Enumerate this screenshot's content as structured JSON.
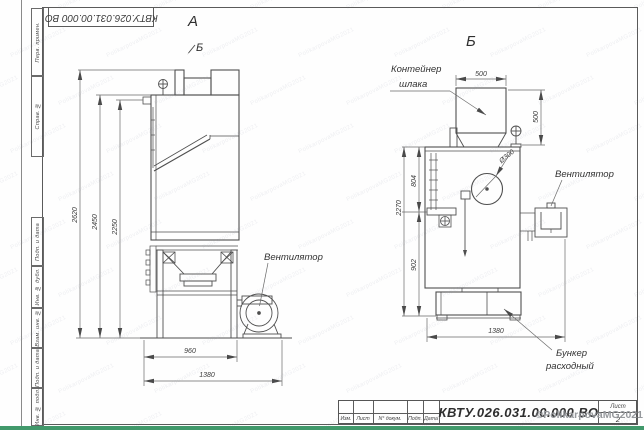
{
  "frame": {
    "top_stamp": "КВТУ.026.031.00.000 ВО",
    "side_fields": [
      {
        "label": "Перв. примен."
      },
      {
        "label": "Справ. №"
      },
      {
        "label": "Подп. и дата"
      },
      {
        "label": "Инв. № дубл."
      },
      {
        "label": "Взам. инв. №"
      },
      {
        "label": "Подп. и дата"
      },
      {
        "label": "Инв. № подл."
      }
    ]
  },
  "title_block": {
    "designation": "КВТУ.026.031.00.000 ВО",
    "columns": [
      "Изм.",
      "Лист",
      "N° докум.",
      "Подп.",
      "Дата"
    ],
    "sheet_label": "Лист",
    "sheet_number": "2"
  },
  "views": {
    "front": {
      "label": "А",
      "direction_label": "Б",
      "dims": {
        "h1": "2620",
        "h2": "2450",
        "h3": "2250",
        "w1": "960",
        "w2": "1380"
      },
      "callouts": {
        "fan": "Вентилятор"
      }
    },
    "side": {
      "label": "Б",
      "dims": {
        "w_top": "500",
        "h_right": "500",
        "h_total": "2270",
        "h1": "804",
        "h2": "902",
        "w_bottom": "1380",
        "diameter": "Ø300"
      },
      "callouts": {
        "container_line1": "Контейнер",
        "container_line2": "шлака",
        "fan": "Вентилятор",
        "hopper_line1": "Бункер",
        "hopper_line2": "расходный"
      }
    }
  },
  "watermarks": {
    "copyright": "©PolikarpovaMG2021",
    "tile_text": "PolikarpovaMG2021"
  }
}
